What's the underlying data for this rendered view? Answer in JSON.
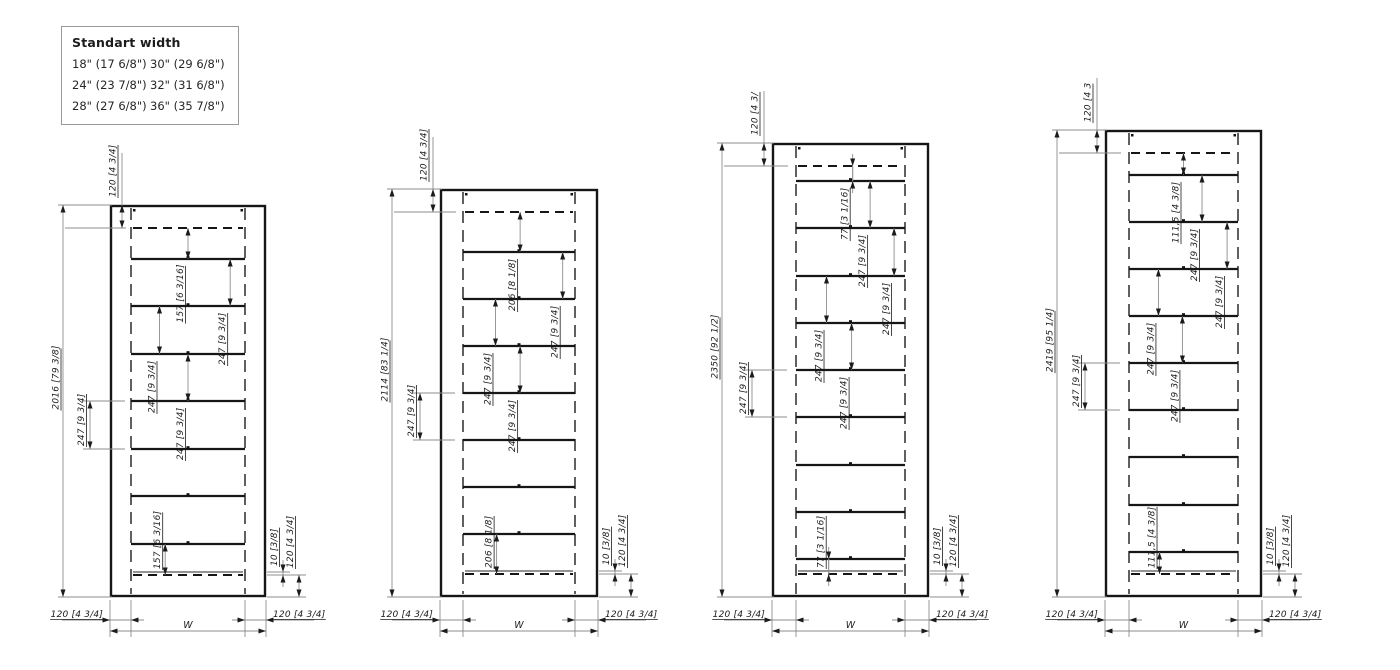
{
  "legend": {
    "title": "Standart width",
    "options": [
      [
        "18\" (17 6/8\")",
        "30\" (29 6/8\")"
      ],
      [
        "24\" (23 7/8\")",
        "32\" (31 6/8\")"
      ],
      [
        "28\" (27 6/8\")",
        "36\" (35 7/8\")"
      ]
    ]
  },
  "units": [
    {
      "name": "shelf-unit-2016",
      "total_height": "2016 [79 3/8]",
      "top_inset": "120 [4 3/4]",
      "shelf_count": 7,
      "gap_dims": [
        {
          "gap": 0,
          "label": "157 [6 3/16]"
        },
        {
          "gap": 1,
          "label": "247 [9 3/4]"
        },
        {
          "gap": 2,
          "label": "247 [9 3/4]"
        },
        {
          "gap": 3,
          "label": "247 [9 3/4]"
        },
        {
          "gap": 7,
          "label": "157 [6 3/16]"
        }
      ],
      "ext_dim": {
        "gap": 4,
        "label": "247 [9 3/4]"
      },
      "bottom_detail": {
        "back_gap": "10 [3/8]",
        "base_height": "120 [4 3/4]"
      },
      "left_panel": "120 [4 3/4]",
      "right_panel": "120 [4 3/4]",
      "width_label": "W"
    },
    {
      "name": "shelf-unit-2114",
      "total_height": "2114 [83 1/4]",
      "top_inset": "120 [4 3/4]",
      "shelf_count": 7,
      "gap_dims": [
        {
          "gap": 0,
          "label": "206 [8 1/8]"
        },
        {
          "gap": 1,
          "label": "247 [9 3/4]"
        },
        {
          "gap": 2,
          "label": "247 [9 3/4]"
        },
        {
          "gap": 3,
          "label": "247 [9 3/4]"
        },
        {
          "gap": 7,
          "label": "206 [8 1/8]"
        }
      ],
      "ext_dim": {
        "gap": 4,
        "label": "247 [9 3/4]"
      },
      "bottom_detail": {
        "back_gap": "10 [3/8]",
        "base_height": "120 [4 3/4]"
      },
      "left_panel": "120 [4 3/4]",
      "right_panel": "120 [4 3/4]",
      "width_label": "W"
    },
    {
      "name": "shelf-unit-2350",
      "total_height": "2350 [92 1/2]",
      "top_inset": "120 [4 3/",
      "shelf_count": 9,
      "gap_dims": [
        {
          "gap": 0,
          "label": "77 [3 1/16]"
        },
        {
          "gap": 1,
          "label": "247 [9 3/4]"
        },
        {
          "gap": 2,
          "label": "247 [9 3/4]"
        },
        {
          "gap": 3,
          "label": "247 [9 3/4]"
        },
        {
          "gap": 4,
          "label": "247 [9 3/4]"
        },
        {
          "gap": 9,
          "label": "77 [3 1/16]"
        }
      ],
      "ext_dim": {
        "gap": 5,
        "label": "247 [9 3/4]"
      },
      "bottom_detail": {
        "back_gap": "10 [3/8]",
        "base_height": "120 [4 3/4]"
      },
      "left_panel": "120 [4 3/4]",
      "right_panel": "120 [4 3/4]",
      "width_label": "W"
    },
    {
      "name": "shelf-unit-2419",
      "total_height": "2419 [95 1/4]",
      "top_inset": "120 [4 3",
      "shelf_count": 9,
      "gap_dims": [
        {
          "gap": 0,
          "label": "111,5 [4 3/8]"
        },
        {
          "gap": 1,
          "label": "247 [9 3/4]"
        },
        {
          "gap": 2,
          "label": "247 [9 3/4]"
        },
        {
          "gap": 3,
          "label": "247 [9 3/4]"
        },
        {
          "gap": 4,
          "label": "247 [9 3/4]"
        },
        {
          "gap": 9,
          "label": "111,5 [4 3/8]"
        }
      ],
      "ext_dim": {
        "gap": 5,
        "label": "247 [9 3/4]"
      },
      "bottom_detail": {
        "back_gap": "10 [3/8]",
        "base_height": "120 [4 3/4]"
      },
      "left_panel": "120 [4 3/4]",
      "right_panel": "120 [4 3/4]",
      "width_label": "W"
    }
  ]
}
